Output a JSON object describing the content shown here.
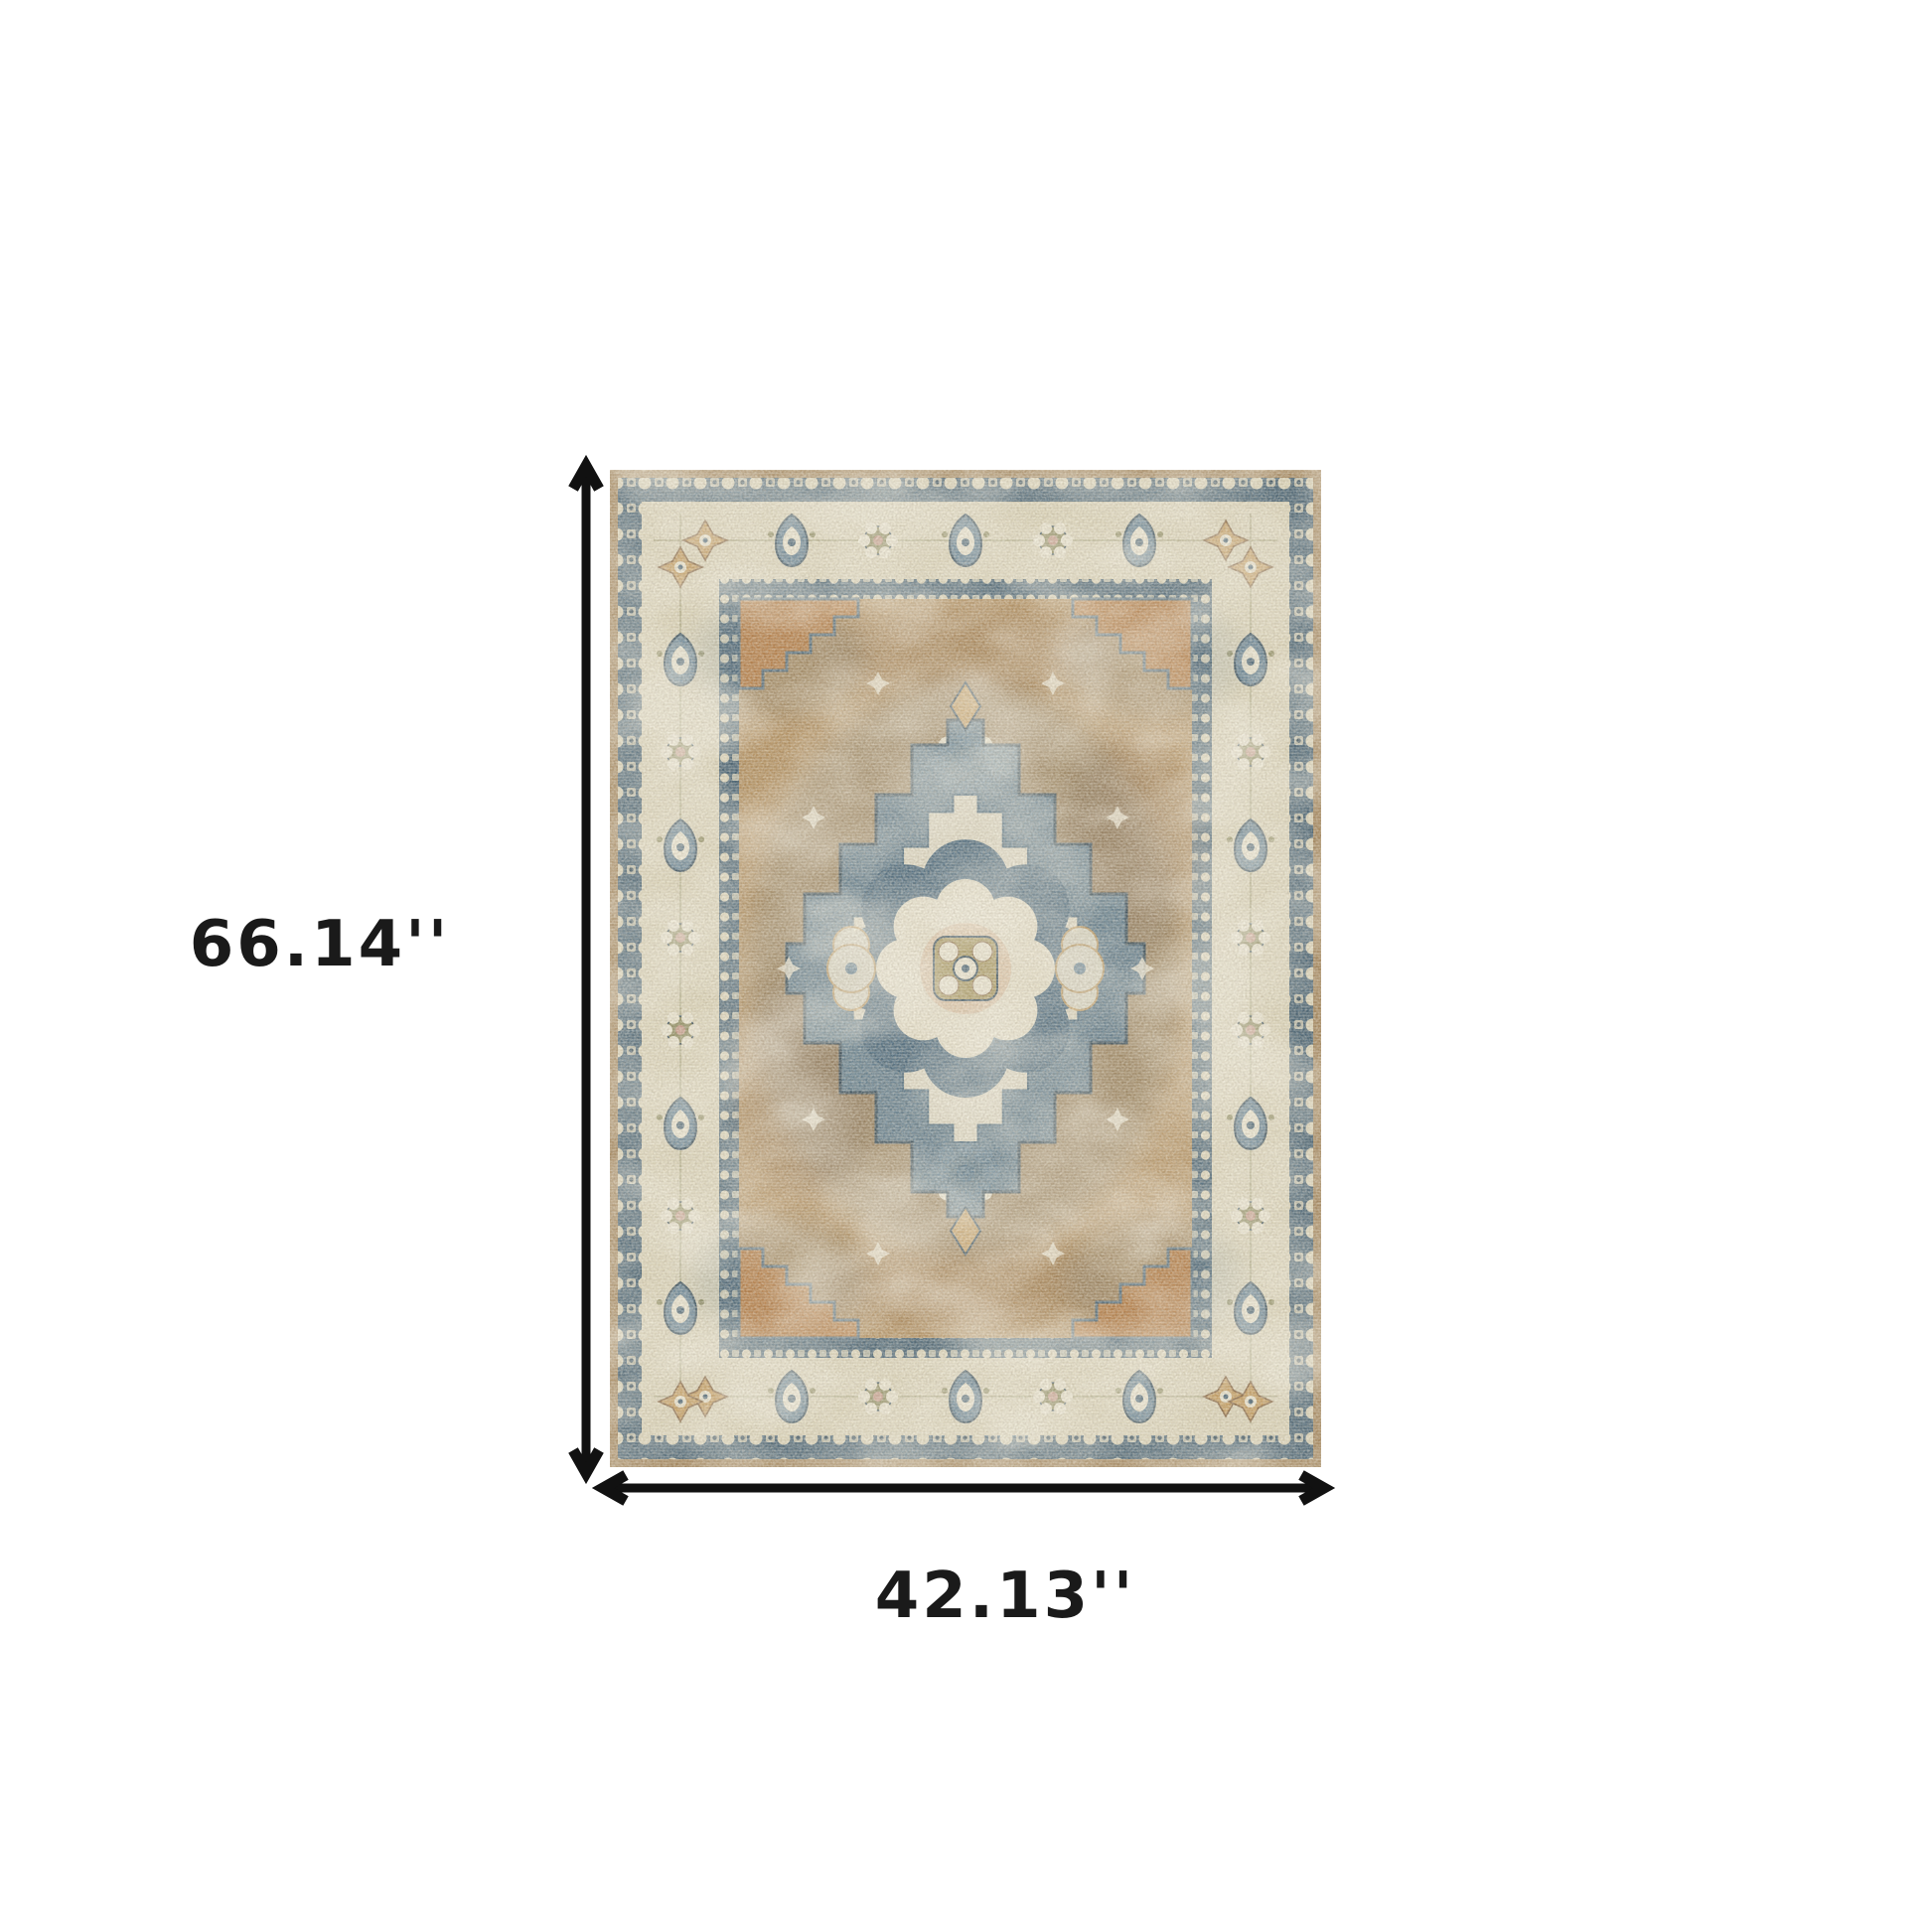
{
  "diagram": {
    "type": "product-dimensions",
    "subject": "vintage-medallion-area-rug",
    "height_label": "66.14''",
    "width_label": "42.13''"
  },
  "colors": {
    "background": "#ffffff",
    "arrow": "#111111",
    "label-text": "#1a1a1a",
    "edge-tan": "#a28258",
    "navy": "#3d5a6f",
    "navy-dark": "#2c4557",
    "cream": "#ddd5ba",
    "cream-light": "#ece6d2",
    "ivory": "#e7e0ca",
    "field-tan": "#b18b59",
    "field-brown": "#83613f",
    "field-orange": "#b5783f",
    "blue": "#5d7c92",
    "blue-deep": "#46657c",
    "olive": "#8d8a5e",
    "olive-gold": "#a6955c",
    "gold": "#c59c5f",
    "peach": "#dcc0a2",
    "pink": "#c79a8a"
  }
}
